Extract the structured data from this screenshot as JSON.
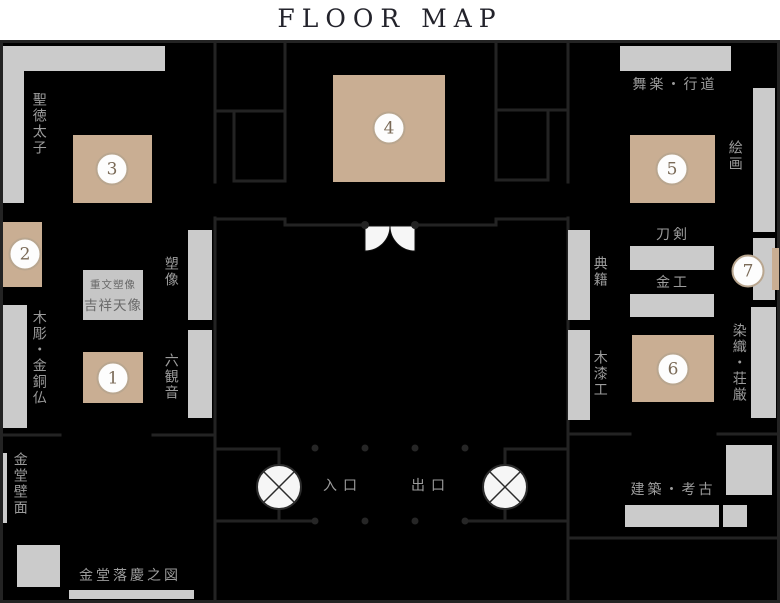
{
  "title": "FLOOR MAP",
  "map": {
    "entrance_label": "入口",
    "exit_label": "出口",
    "zones": {
      "shotoku_taishi": "聖徳太子",
      "mokucho_kondobutsu": "木彫・金銅仏",
      "kondo_hekimen": "金堂壁面",
      "kondo_rakkei_no_zu": "金堂落慶之図",
      "sozo": "塑像",
      "rokkannon": "六観音",
      "bugaku_gyodo": "舞楽・行道",
      "kaiga": "絵画",
      "token": "刀剣",
      "kinko": "金工",
      "tenseki": "典籍",
      "mokushikko": "木漆工",
      "senshoku_shogon": "染織・荘厳",
      "kenchiku_koko": "建築・考古"
    },
    "note_box": {
      "line1": "重文塑像",
      "line2": "吉祥天像"
    },
    "markers": [
      {
        "number": "1"
      },
      {
        "number": "2"
      },
      {
        "number": "3"
      },
      {
        "number": "4"
      },
      {
        "number": "5"
      },
      {
        "number": "6"
      },
      {
        "number": "7"
      }
    ],
    "colors": {
      "background": "#000000",
      "wall_line": "#232323",
      "panel_gray": "#cbcbcb",
      "exhibit_tan": "#c9ae93",
      "marker_border": "#b9a68f",
      "marker_number": "#7a6a57",
      "label_gray": "#9c9c9c",
      "door_white": "#f6f6f6"
    }
  }
}
